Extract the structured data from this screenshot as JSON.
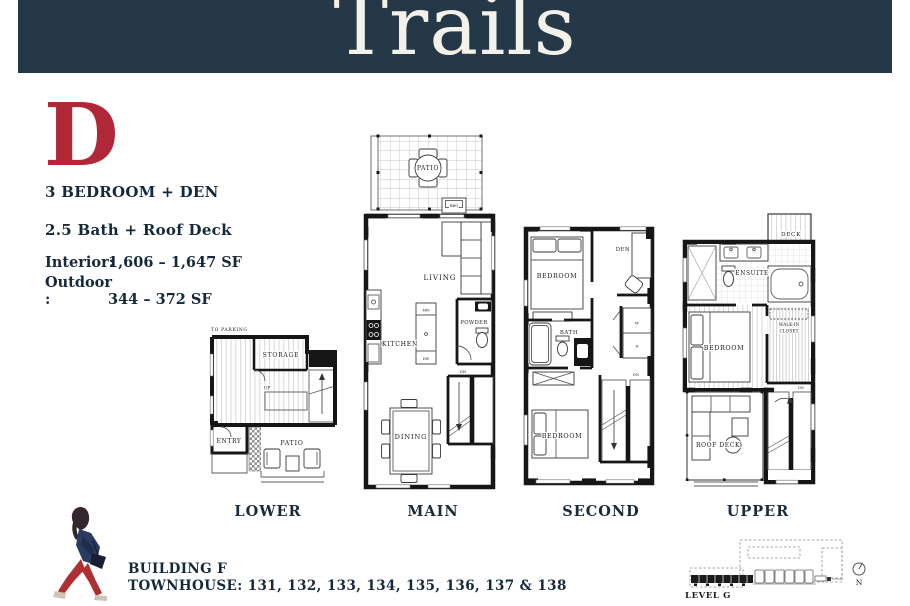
{
  "header": {
    "title": "Trails",
    "bg_color": "#253847"
  },
  "plan": {
    "letter": "D",
    "letter_color": "#b02838",
    "type_line": "3 BEDROOM + DEN",
    "bath_line": "2.5 Bath + Roof Deck",
    "interior_label": "Interior:",
    "interior_value": "1,606 – 1,647 SF",
    "outdoor_label": "Outdoor :",
    "outdoor_value": "344 – 372 SF"
  },
  "floors": [
    {
      "name": "LOWER",
      "labels": {
        "to_parking": "TO PARKING",
        "storage": "STORAGE",
        "up": "UP",
        "entry": "ENTRY",
        "patio": "PATIO"
      }
    },
    {
      "name": "MAIN",
      "labels": {
        "patio": "PATIO",
        "bbq": "BBQ",
        "living": "LIVING",
        "kitchen": "KITCHEN",
        "mw": "MW",
        "dw": "DW",
        "powder": "POWDER",
        "dn": "DN",
        "dining": "DINING"
      }
    },
    {
      "name": "SECOND",
      "labels": {
        "bedroom_top": "BEDROOM",
        "den": "DEN",
        "bath": "BATH",
        "washer": "W",
        "dryer": "D",
        "bedroom_bottom": "BEDROOM",
        "dn": "DN"
      }
    },
    {
      "name": "UPPER",
      "labels": {
        "deck": "DECK",
        "ensuite": "ENSUITE",
        "walk_in_line1": "WALK-IN",
        "walk_in_line2": "CLOSET",
        "bedroom": "BEDROOM",
        "roof_deck": "ROOF DECK",
        "dn": "DN"
      }
    }
  ],
  "footer": {
    "building": "BUILDING F",
    "townhouses": "TOWNHOUSE: 131, 132, 133, 134, 135, 136, 137 & 138",
    "site_level": "LEVEL G",
    "north": "N"
  }
}
